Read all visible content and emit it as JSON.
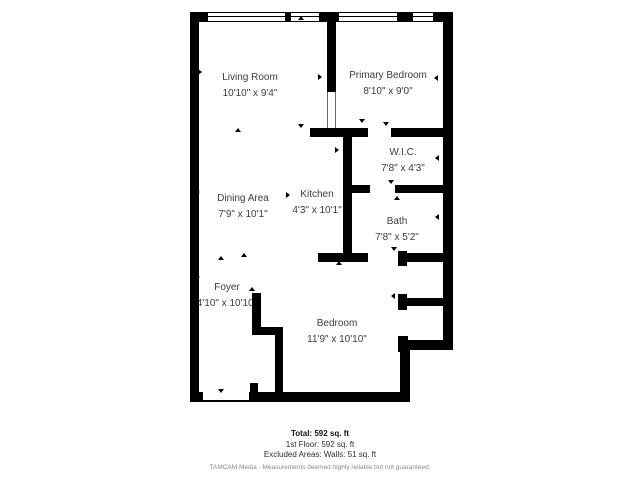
{
  "floorplan": {
    "rooms": [
      {
        "name": "Living Room",
        "dims": "10'10\" x 9'4\""
      },
      {
        "name": "Primary Bedroom",
        "dims": "8'10\" x 9'0\""
      },
      {
        "name": "W.I.C.",
        "dims": "7'8\" x 4'3\""
      },
      {
        "name": "Bath",
        "dims": "7'8\" x 5'2\""
      },
      {
        "name": "Dining Area",
        "dims": "7'9\" x 10'1\""
      },
      {
        "name": "Kitchen",
        "dims": "4'3\" x 10'1\""
      },
      {
        "name": "Foyer",
        "dims": "4'10\" x 10'10\""
      },
      {
        "name": "Bedroom",
        "dims": "11'9\" x 10'10\""
      }
    ],
    "footer": {
      "total": "Total: 592 sq. ft",
      "first_floor": "1st Floor: 592 sq. ft",
      "excluded": "Excluded Areas: Walls: 51 sq. ft",
      "disclaimer": "TAMCAM Media - Measurements deemed highly reliable but not guaranteed."
    },
    "colors": {
      "wall": "#000000",
      "label_text": "#3c3c3c",
      "disclaimer_text": "#8a8a8a",
      "background": "#ffffff"
    }
  }
}
